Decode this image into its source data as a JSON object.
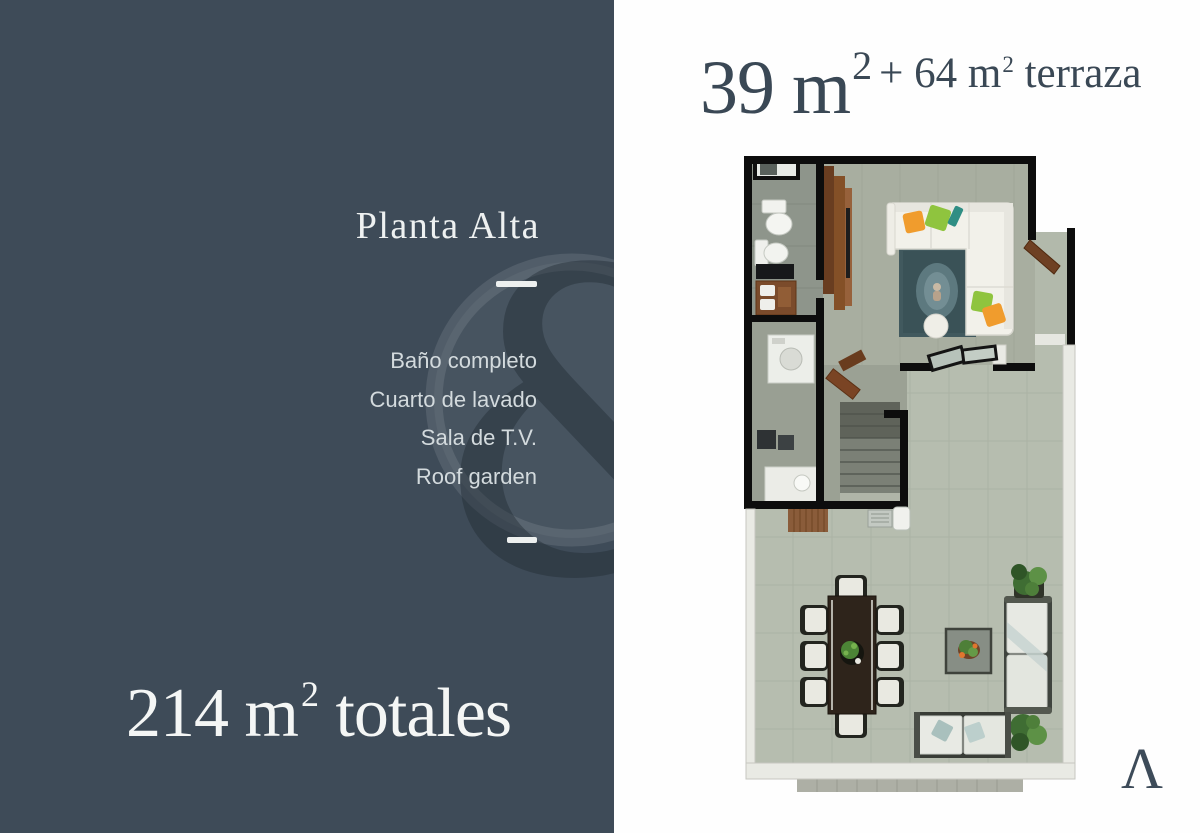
{
  "left_panel": {
    "background": "#3e4b58",
    "title": "Planta Alta",
    "features": [
      "Baño completo",
      "Cuarto de lavado",
      "Sala de T.V.",
      "Roof garden"
    ],
    "total_area": {
      "lead": "214 m",
      "sup": "2",
      "tail": " totales"
    }
  },
  "right_panel": {
    "background": "#fefefe",
    "area_title": {
      "big": "39 m",
      "big_sup": "2",
      "small": "+ 64 m",
      "small_sup": "2",
      "small_tail": " terraza"
    },
    "brand_glyph": "Λ"
  },
  "watermark": {
    "glyph": "&"
  },
  "floorplan": {
    "palette": {
      "wall": "#0d0d0d",
      "terrace_floor": "#b6bdaf",
      "tv_room_floor": "#a8aea0",
      "bathroom_floor": "#8e958b",
      "parapet": "#e9eae4",
      "wood": "#845027",
      "rug": "#41595e",
      "sofa": "#f2f1ea",
      "pillow_green": "#8fc43e",
      "pillow_orange": "#f09c2d",
      "foliage": "#4a7a3c"
    }
  }
}
